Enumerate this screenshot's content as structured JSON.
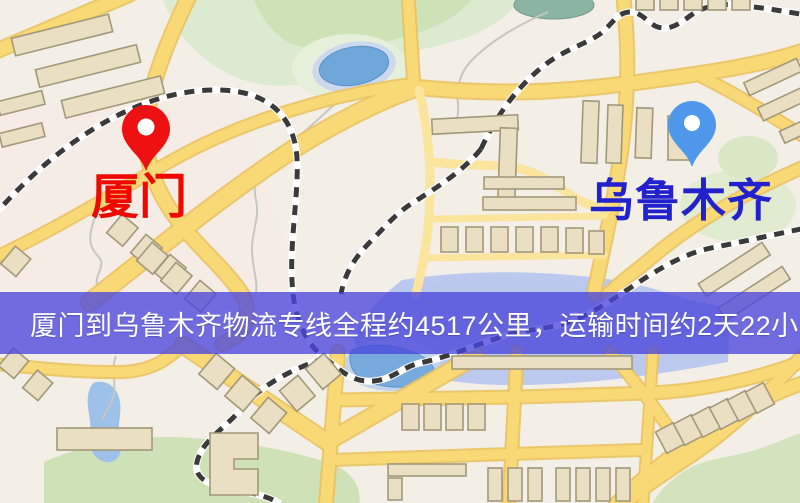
{
  "map": {
    "origin": {
      "label": "厦门",
      "label_color": "#ed0800",
      "pin_color": "#ee1111",
      "pin_icon": "red-location-pin"
    },
    "destination": {
      "label": "乌鲁木齐",
      "label_color": "#2121cd",
      "pin_color": "#4e97ea",
      "pin_icon": "blue-location-pin"
    },
    "banner": {
      "text": "厦门到乌鲁木齐物流专线全程约4517公里，运输时间约2天22小时.",
      "bg_color": "#4a46dc",
      "text_color": "#ffffff"
    },
    "style_colors": {
      "road_yellow": "#f9d876",
      "railway_dark": "#3a3a3a",
      "building_tan": "#eadfc3",
      "park_green": "#d5e4c4",
      "water_blue": "#78abdd"
    }
  }
}
